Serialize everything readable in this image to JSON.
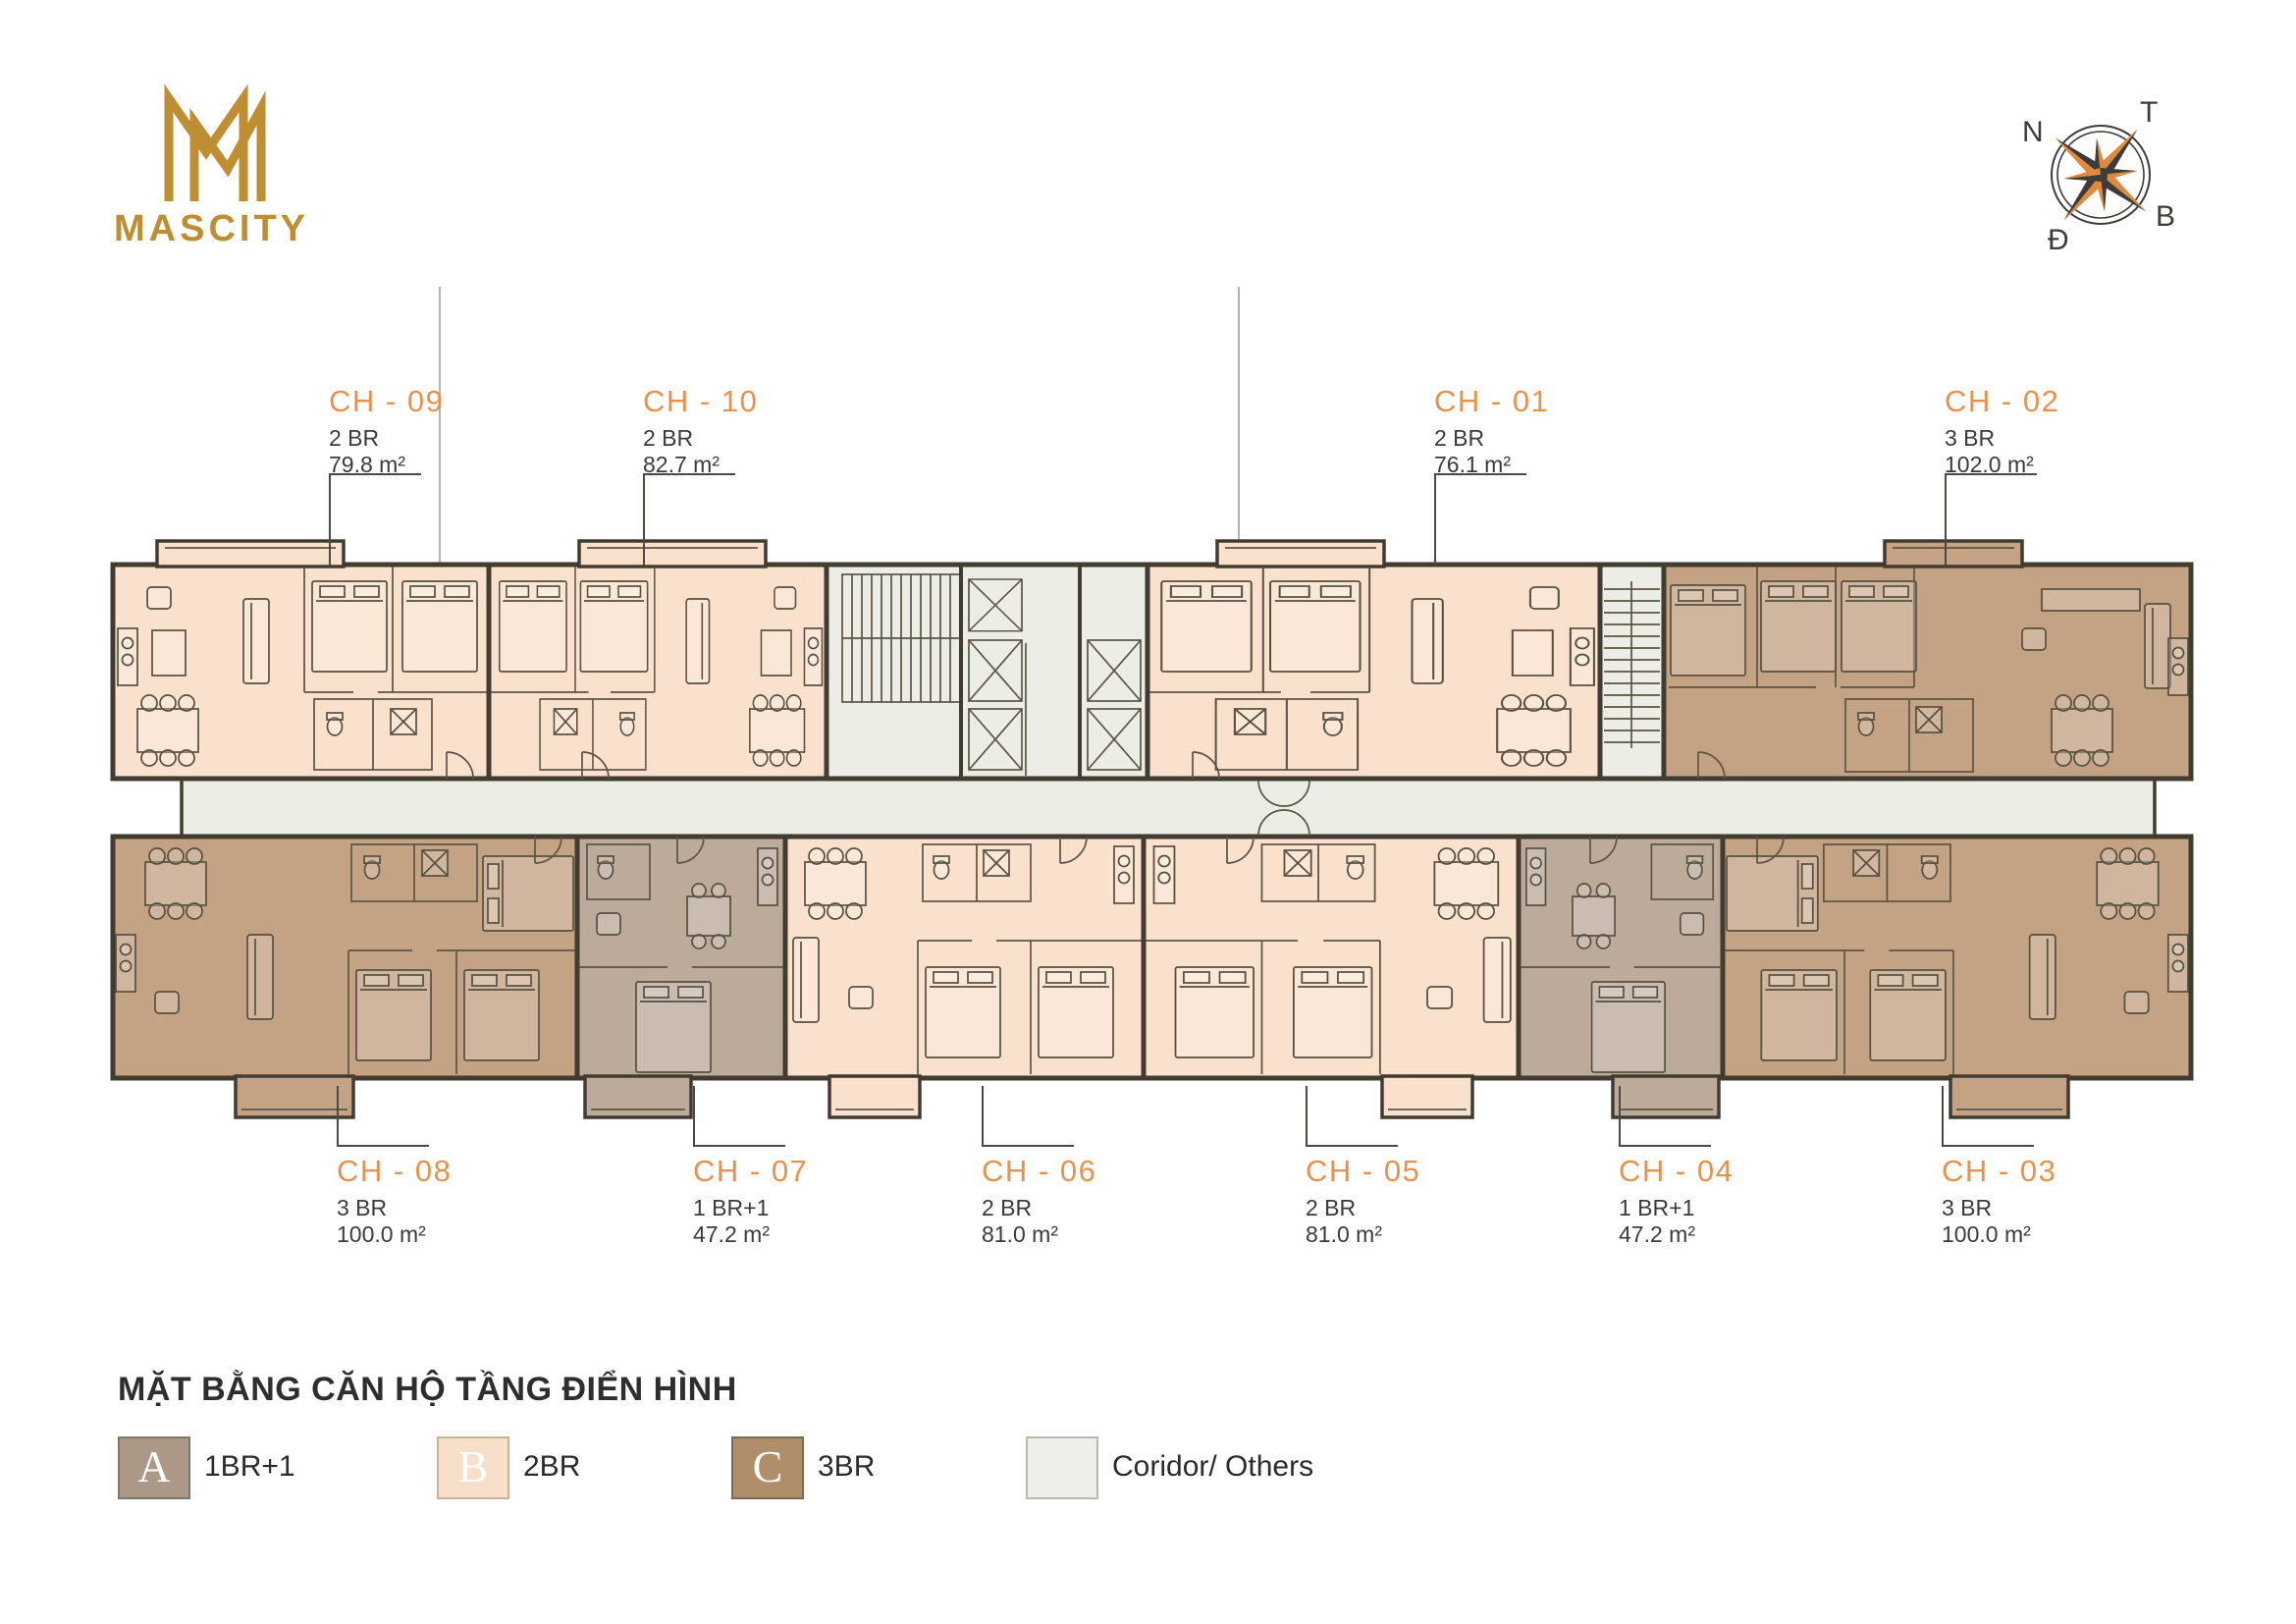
{
  "brand": {
    "name": "MASCITY"
  },
  "compass": {
    "n": "N",
    "t": "T",
    "b": "B",
    "d": "Đ"
  },
  "title": "MẶT BẰNG CĂN HỘ TẦNG ĐIỂN HÌNH",
  "apartments": [
    {
      "code": "CH - 09",
      "type": "2 BR",
      "area": "79.8 m²"
    },
    {
      "code": "CH - 10",
      "type": "2 BR",
      "area": "82.7 m²"
    },
    {
      "code": "CH - 01",
      "type": "2 BR",
      "area": "76.1 m²"
    },
    {
      "code": "CH - 02",
      "type": "3 BR",
      "area": "102.0 m²"
    },
    {
      "code": "CH - 08",
      "type": "3 BR",
      "area": "100.0 m²"
    },
    {
      "code": "CH - 07",
      "type": "1 BR+1",
      "area": "47.2 m²"
    },
    {
      "code": "CH - 06",
      "type": "2 BR",
      "area": "81.0 m²"
    },
    {
      "code": "CH - 05",
      "type": "2 BR",
      "area": "81.0 m²"
    },
    {
      "code": "CH - 04",
      "type": "1 BR+1",
      "area": "47.2 m²"
    },
    {
      "code": "CH - 03",
      "type": "3 BR",
      "area": "100.0 m²"
    }
  ],
  "legend": {
    "items": [
      {
        "letter": "A",
        "label": "1BR+1",
        "color": "#AB9887"
      },
      {
        "letter": "B",
        "label": "2BR",
        "color": "#F8DFC9"
      },
      {
        "letter": "C",
        "label": "3BR",
        "color": "#B08D6B"
      },
      {
        "letter": "",
        "label": "Coridor/ Others",
        "color": "#EEEFE8"
      }
    ]
  },
  "colors": {
    "gold": "#BF8E33",
    "label_orange": "#E8914D",
    "text_dark": "#3B3B3B",
    "wall": "#413B30",
    "type_1br1": "#BCAA9B",
    "type_2br": "#F9E1CD",
    "type_3br": "#C4A284",
    "corridor": "#ECEDE4",
    "compass_orange": "#DF8A3C",
    "compass_dark": "#3E3B38"
  }
}
